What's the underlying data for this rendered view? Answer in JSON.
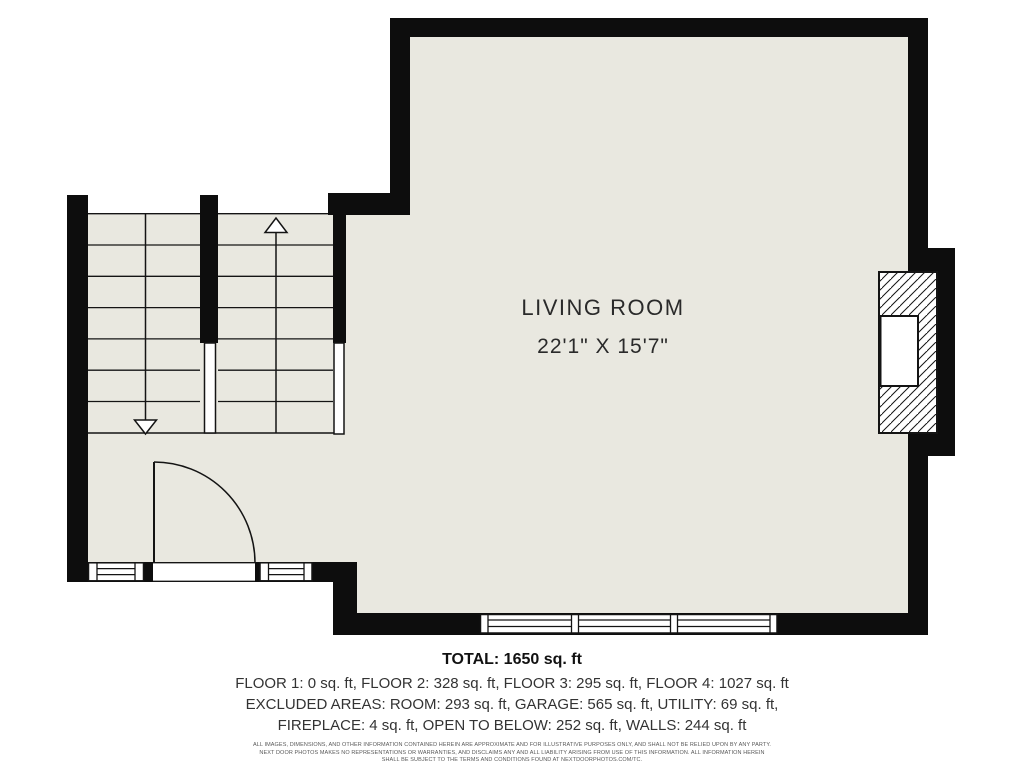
{
  "plan": {
    "room_label": "LIVING ROOM",
    "room_dimensions": "22'1\" X 15'7\"",
    "symbols": {
      "stairs_up_arrow": "up-direction-arrow",
      "stairs_down_arrow": "down-direction-arrow",
      "door": "quarter-swing-door",
      "fireplace": "hatched-chimney-with-firebox",
      "windows": "triple-pane-window-band"
    },
    "colors": {
      "floor": "#e9e8e0",
      "wall": "#0d0d0d",
      "line": "#141414",
      "background": "#ffffff"
    }
  },
  "summary": {
    "total": "TOTAL: 1650 sq. ft",
    "floors_line": "FLOOR 1: 0 sq. ft, FLOOR 2: 328 sq. ft, FLOOR 3: 295 sq. ft, FLOOR 4: 1027 sq. ft",
    "excluded_line1": "EXCLUDED AREAS: ROOM: 293 sq. ft, GARAGE: 565 sq. ft, UTILITY: 69 sq. ft,",
    "excluded_line2": "FIREPLACE: 4 sq. ft, OPEN TO BELOW: 252 sq. ft, WALLS: 244 sq. ft"
  },
  "disclaimer": {
    "line1": "ALL IMAGES, DIMENSIONS, AND OTHER INFORMATION CONTAINED HEREIN ARE APPROXIMATE AND FOR ILLUSTRATIVE PURPOSES ONLY, AND SHALL NOT BE RELIED UPON BY ANY PARTY.",
    "line2": "NEXT DOOR PHOTOS MAKES NO REPRESENTATIONS OR WARRANTIES, AND DISCLAIMS ANY AND ALL LIABILITY ARISING FROM USE OF THIS INFORMATION. ALL INFORMATION HEREIN",
    "line3": "SHALL BE SUBJECT TO THE TERMS AND CONDITIONS FOUND AT NEXTDOORPHOTOS.COM/TC."
  }
}
